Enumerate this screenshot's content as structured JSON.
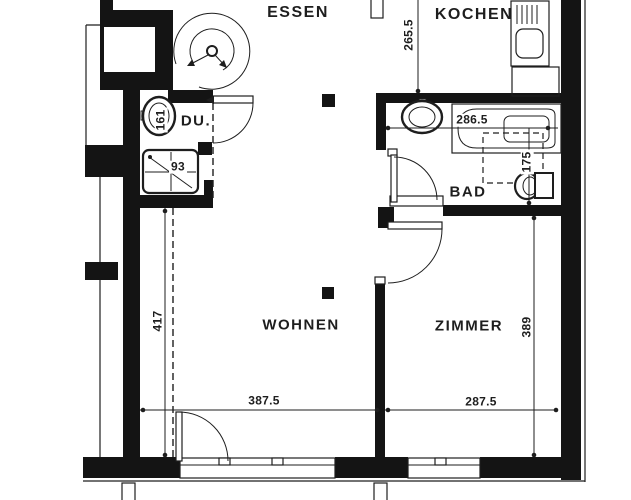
{
  "plan_type": "apartment-floor-plan",
  "rooms": {
    "essen": "ESSEN",
    "kochen": "KOCHEN",
    "du": "DU.",
    "bad": "BAD",
    "wohnen": "WOHNEN",
    "zimmer": "ZIMMER"
  },
  "dimensions": {
    "kochen_height": "265.5",
    "bathtub_width": "286.5",
    "bath_depth": "175",
    "du_basin": "161",
    "shower": "93",
    "wohnen_left_height": "417",
    "wohnen_width": "387.5",
    "zimmer_width": "287.5",
    "zimmer_height": "389"
  },
  "fixtures": [
    "spiral-stove",
    "kitchen-sink",
    "kitchen-counter",
    "bathtub",
    "bad-washbasin",
    "toilet",
    "du-washbasin",
    "shower-tray"
  ],
  "colors": {
    "wall": "#141414",
    "line": "#1e1e1e",
    "background": "#ffffff"
  }
}
